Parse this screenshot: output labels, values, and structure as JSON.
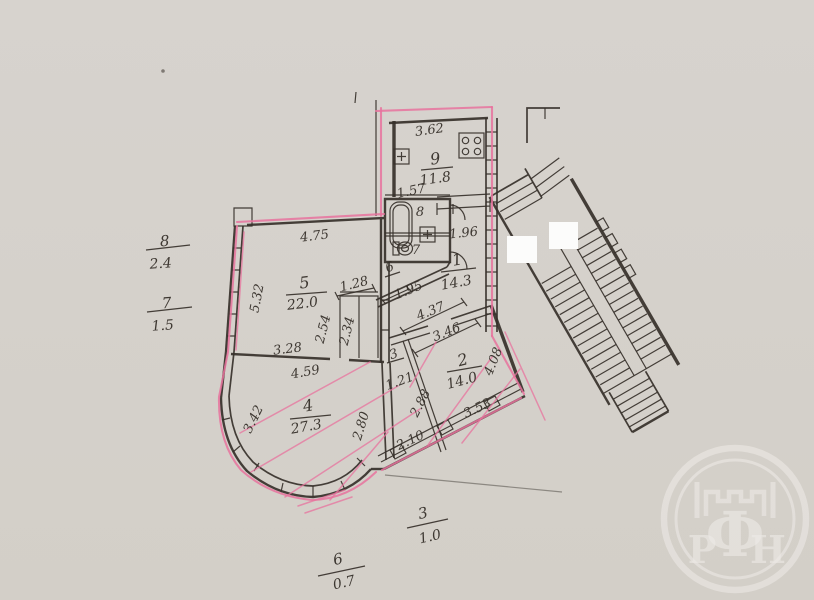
{
  "colors": {
    "paper": "#d5d1cb",
    "ink": "#36302a",
    "pink": "#e8739d",
    "redaction": "#fcfcfb",
    "watermark": "#eeebe7"
  },
  "plan": {
    "rooms": {
      "r1": {
        "num": "1",
        "area": "14.3"
      },
      "r2": {
        "num": "2",
        "area": "14.0"
      },
      "r3": {
        "num": "3"
      },
      "r4": {
        "num": "4",
        "area": "27.3"
      },
      "r5": {
        "num": "5",
        "area": "22.0"
      },
      "r6": {
        "num": "6"
      },
      "r7": {
        "num": "7"
      },
      "r8": {
        "num": "8"
      },
      "r9": {
        "num": "9",
        "area": "11.8"
      }
    },
    "dims": {
      "kitchen_width": "3.62",
      "kitchen_nook": "1.57",
      "kitchen_opening": "1.96",
      "hall_width": "1.95",
      "hall_length_upper": "4.37",
      "hall_length_lower": "3.46",
      "room5_width": "4.75",
      "room5_depth": "5.32",
      "room5_bottom": "3.28",
      "closet_width": "1.28",
      "closet_depth_left": "2.54",
      "closet_depth_right": "2.34",
      "room4_top": "4.59",
      "room4_left": "3.42",
      "room4_right": "2.80",
      "room3_width": "1.21",
      "room3_length": "2.88",
      "room3_window": "2.10",
      "room2_window": "3.53",
      "room2_right": "4.08"
    },
    "margin_labels": {
      "left_upper": {
        "num": "8",
        "value": "2.4"
      },
      "left_lower": {
        "num": "7",
        "value": "1.5"
      },
      "bottom_right": {
        "num": "3",
        "value": "1.0"
      },
      "bottom_left": {
        "num": "6",
        "value": "0.7"
      }
    }
  },
  "watermark": {
    "letter_left": "Р",
    "letter_center": "Ф",
    "letter_right": "Н"
  }
}
